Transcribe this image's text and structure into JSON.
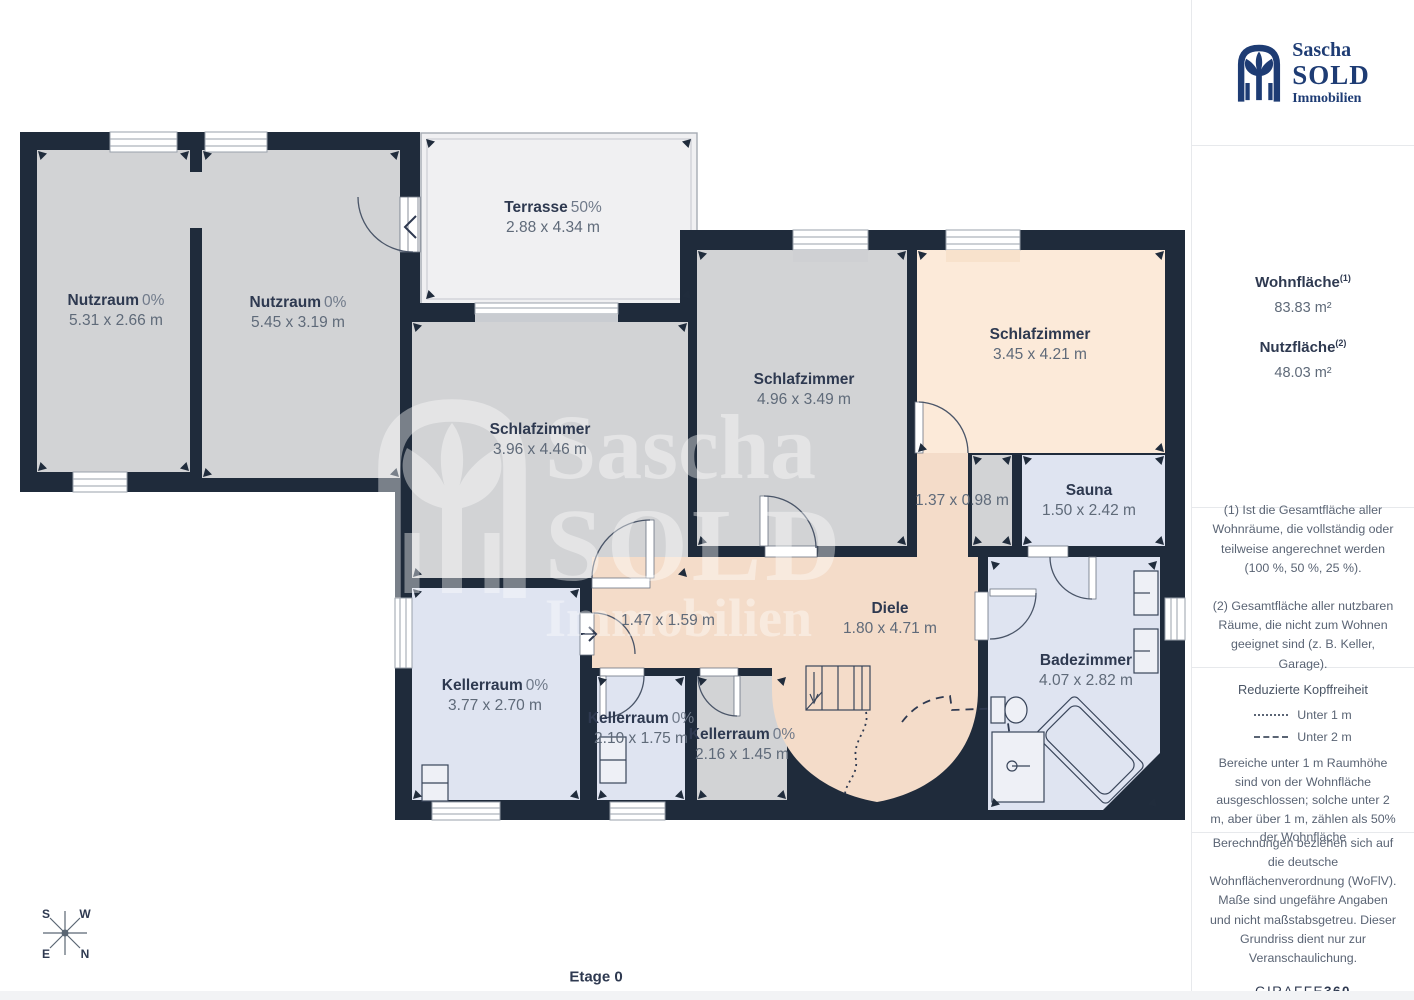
{
  "plan": {
    "floor_label": "Etage 0",
    "compass": {
      "s": "S",
      "w": "W",
      "e": "E",
      "n": "N"
    },
    "rooms": {
      "nutzraum1": {
        "name": "Nutzraum",
        "pct": "0%",
        "dims": "5.31 x 2.66 m"
      },
      "nutzraum2": {
        "name": "Nutzraum",
        "pct": "0%",
        "dims": "5.45 x 3.19 m"
      },
      "terrasse": {
        "name": "Terrasse",
        "pct": "50%",
        "dims": "2.88 x 4.34 m"
      },
      "schlafzimmer1": {
        "name": "Schlafzimmer",
        "dims": "3.96 x 4.46 m"
      },
      "schlafzimmer2": {
        "name": "Schlafzimmer",
        "dims": "4.96 x 3.49 m"
      },
      "schlafzimmer3": {
        "name": "Schlafzimmer",
        "dims": "3.45 x 4.21 m"
      },
      "flur_klein": {
        "dims": "1.37 x 0.98 m"
      },
      "sauna": {
        "name": "Sauna",
        "dims": "1.50 x 2.42 m"
      },
      "diele": {
        "name": "Diele",
        "dims": "1.80 x 4.71 m"
      },
      "flur": {
        "dims": "1.47 x 1.59 m"
      },
      "kellerraum1": {
        "name": "Kellerraum",
        "pct": "0%",
        "dims": "3.77 x 2.70 m"
      },
      "kellerraum2": {
        "name": "Kellerraum",
        "pct": "0%",
        "dims": "2.10 x 1.75 m"
      },
      "kellerraum3": {
        "name": "Kellerraum",
        "pct": "0%",
        "dims": "2.16 x 1.45 m"
      },
      "badezimmer": {
        "name": "Badezimmer",
        "dims": "4.07 x 2.82 m"
      }
    },
    "watermark": {
      "line1": "Sascha",
      "line2": "SOLD",
      "line3": "Immobilien"
    }
  },
  "sidebar": {
    "logo": {
      "line1": "Sascha",
      "line2": "SOLD",
      "line3": "Immobilien"
    },
    "areas": {
      "wohnflaeche_label": "Wohnfläche",
      "wohnflaeche_sup": "(1)",
      "wohnflaeche_value": "83.83 m²",
      "nutzflaeche_label": "Nutzfläche",
      "nutzflaeche_sup": "(2)",
      "nutzflaeche_value": "48.03 m²"
    },
    "footnotes": {
      "note1": "(1) Ist die Gesamtfläche aller Wohnräume, die vollständig oder teilweise angerechnet werden (100 %, 50 %, 25 %).",
      "note2": "(2) Gesamtfläche aller nutzbaren Räume, die nicht zum Wohnen geeignet sind (z. B. Keller, Garage)."
    },
    "headroom": {
      "title": "Reduzierte Kopffreiheit",
      "legend1": "Unter 1 m",
      "legend2": "Unter 2 m",
      "body": "Bereiche unter 1 m Raumhöhe sind von der Wohnfläche ausgeschlossen; solche unter 2 m, aber über 1 m, zählen als 50% der Wohnfläche"
    },
    "disclaimer": {
      "body": "Berechnungen beziehen sich auf die deutsche Wohnflächenverordnung (WoFlV). Maße sind ungefähre Angaben und nicht maßstabsgetreu. Dieser Grundriss dient nur zur Veranschaulichung.",
      "brand_normal": "GIRAFFE",
      "brand_bold": "360"
    }
  },
  "colors": {
    "wall": "#1f2b3b",
    "room_gray": "#d2d3d5",
    "room_peach_light": "#fcead9",
    "room_peach": "#f4dcc9",
    "room_blue": "#dfe4f1",
    "terrace": "#f0f0f2",
    "logo_blue": "#1e3c74"
  }
}
